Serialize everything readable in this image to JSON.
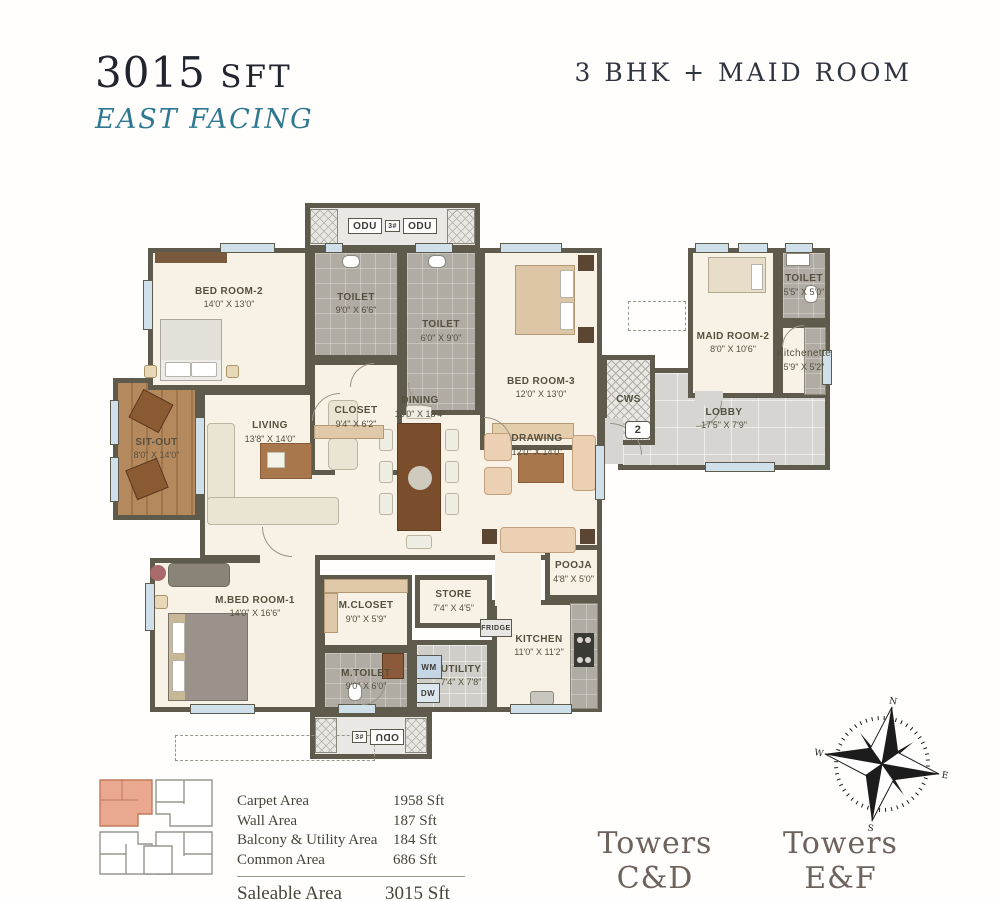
{
  "header": {
    "area_value": "3015",
    "area_unit": "SFT",
    "facing": "EAST FACING",
    "unit_type": "3 BHK + MAID ROOM"
  },
  "plan": {
    "rooms": {
      "bedroom2": {
        "name": "BED ROOM-2",
        "dims": "14'0\" X 13'0\""
      },
      "toilet_a": {
        "name": "TOILET",
        "dims": "9'0\" X 6'6\""
      },
      "closet": {
        "name": "CLOSET",
        "dims": "9'4\" X 6'2\""
      },
      "toilet_b": {
        "name": "TOILET",
        "dims": "6'0\" X 9'0\""
      },
      "bedroom3": {
        "name": "BED ROOM-3",
        "dims": "12'0\" X 13'0\""
      },
      "maidroom": {
        "name": "MAID ROOM-2",
        "dims": "8'0\" X 10'6\""
      },
      "maidtoilet": {
        "name": "TOILET",
        "dims": "5'5\" X 5'0\""
      },
      "kitchenette": {
        "name": "Kitchenette",
        "dims": "5'9\" X 5'2\""
      },
      "lobby": {
        "name": "LOBBY",
        "dims": "17'5\" X 7'9\""
      },
      "sitout": {
        "name": "SIT-OUT",
        "dims": "8'0\" X 14'0\""
      },
      "living": {
        "name": "LIVING",
        "dims": "13'8\" X 14'0\""
      },
      "dining": {
        "name": "DINING",
        "dims": "13'0\" X 18'4\""
      },
      "drawing": {
        "name": "DRAWING",
        "dims": "12'0\" X 14'0\""
      },
      "pooja": {
        "name": "POOJA",
        "dims": "4'8\" X 5'0\""
      },
      "mbedroom": {
        "name": "M.BED ROOM-1",
        "dims": "14'0\" X 16'6\""
      },
      "mcloset": {
        "name": "M.CLOSET",
        "dims": "9'0\" X 5'9\""
      },
      "mtoilet": {
        "name": "M.TOILET",
        "dims": "9'0\" X 6'0\""
      },
      "store": {
        "name": "STORE",
        "dims": "7'4\" X 4'5\""
      },
      "utility": {
        "name": "UTILITY",
        "dims": "7'4\" X 7'8\""
      },
      "kitchen": {
        "name": "KITCHEN",
        "dims": "11'0\" X 11'2\""
      }
    },
    "labels": {
      "odu": "ODU",
      "odu_count": "3#",
      "cws": "CWS",
      "fridge": "FRIDGE",
      "wm": "WM",
      "dw": "DW",
      "unit_number": "2"
    },
    "compass": {
      "n": "N",
      "e": "E",
      "s": "S",
      "w": "W"
    }
  },
  "area_table": {
    "rows": [
      {
        "label": "Carpet Area",
        "value": "1958 Sft"
      },
      {
        "label": "Wall Area",
        "value": "187 Sft"
      },
      {
        "label": "Balcony & Utility Area",
        "value": "184 Sft"
      },
      {
        "label": "Common Area",
        "value": "686 Sft"
      }
    ],
    "total": {
      "label": "Saleable Area",
      "value": "3015 Sft"
    }
  },
  "towers": [
    {
      "name": "Towers C&D",
      "subtitle": "Crimson & Dandelion"
    },
    {
      "name": "Towers E&F",
      "subtitle": "Ember & Fedora"
    }
  ],
  "colors": {
    "accent_teal": "#2e7890",
    "wall": "#5e5b4d",
    "floor_cream": "#f8f2e6",
    "keyplan_highlight": "#eaa98e"
  }
}
